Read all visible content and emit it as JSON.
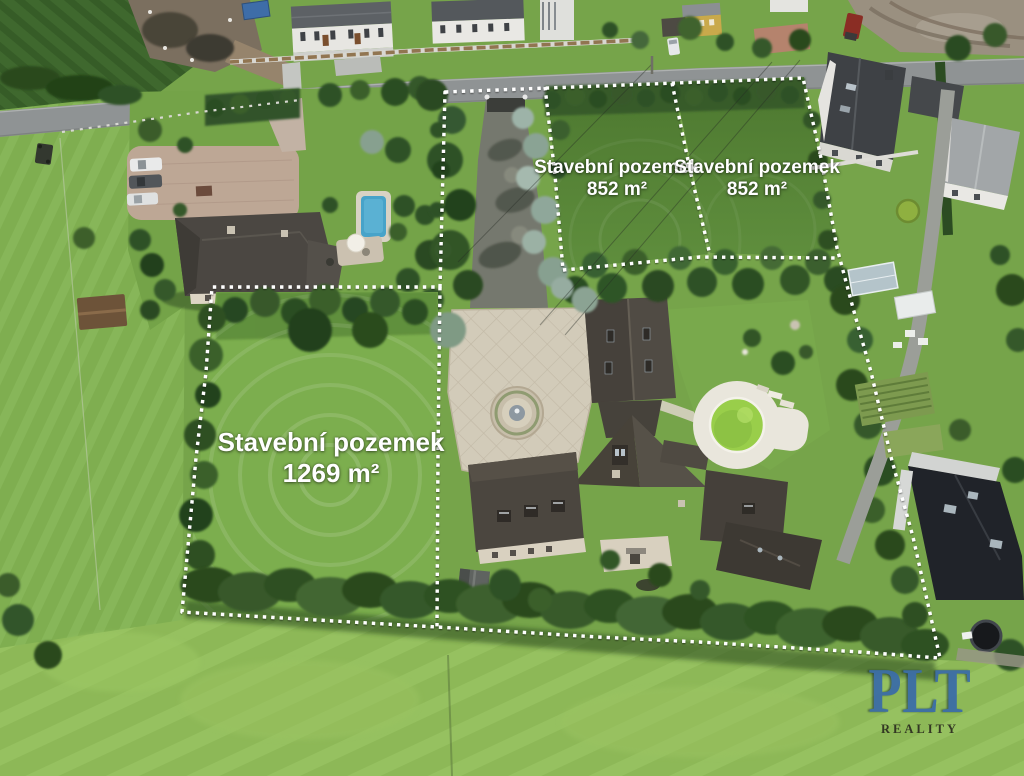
{
  "meta": {
    "description": "Aerial drone photo of a residential property with marked building plots",
    "language": "cs"
  },
  "annotations": {
    "plots": [
      {
        "name": "plot-852-left",
        "title": "Stavební pozemek",
        "area": "852 m²"
      },
      {
        "name": "plot-852-right",
        "title": "Stavební pozemek",
        "area": "852 m²"
      },
      {
        "name": "plot-1269",
        "title": "Stavební pozemek",
        "area": "1269 m²"
      }
    ]
  },
  "watermark": {
    "brand": "PLT",
    "subtitle": "REALITY"
  },
  "colors": {
    "annotation_white": "#ffffff",
    "logo_blue": "#3c6ea6",
    "logo_blue_dark": "#1d3b60",
    "logo_subtitle": "#23211a",
    "lawn_green": "#76a44a",
    "meadow_green": "#8db857",
    "tree_green": "#2f5126",
    "roof_dark": "#49443d",
    "pool_green": "#99ce4a",
    "road_gray": "#8f9394"
  }
}
